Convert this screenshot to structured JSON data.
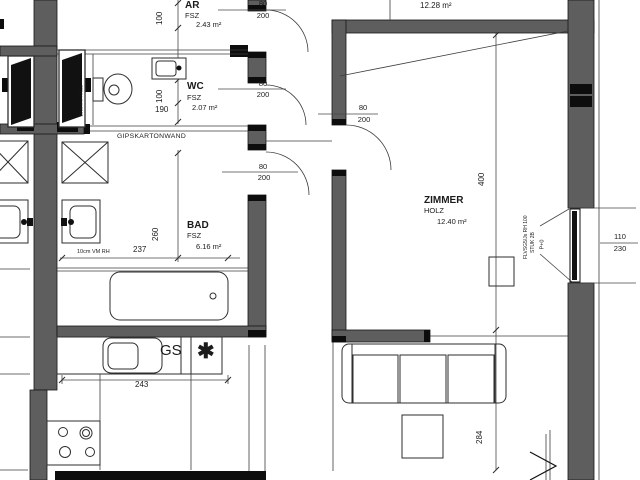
{
  "plan": {
    "rooms": [
      {
        "name": "AR",
        "floor": "FSZ",
        "area": "2.43 m²"
      },
      {
        "name": "WC",
        "floor": "FSZ",
        "area": "2.07 m²"
      },
      {
        "name": "BAD",
        "floor": "FSZ",
        "area": "6.16 m²"
      },
      {
        "name": "ZIMMER",
        "floor": "HOLZ",
        "area": "12.40 m²"
      },
      {
        "name": "HOLZ",
        "floor": "",
        "area": "12.28 m²"
      }
    ],
    "doors": {
      "ar": {
        "w": "80",
        "h": "200"
      },
      "wc": {
        "w": "80",
        "h": "200"
      },
      "bad": {
        "w": "80",
        "h": "200"
      },
      "zimmer": {
        "w": "80",
        "h": "200"
      }
    },
    "window": {
      "w": "110",
      "h": "230"
    },
    "dims": {
      "ar_height": "100",
      "wc_height": "100",
      "wc_width": "190",
      "bad_height": "260",
      "bad_width": "237",
      "kitchen_width": "243",
      "zimmer_height": "400",
      "living_height": "284"
    },
    "notes": {
      "gips": "GIPSKARTONWAND",
      "vm_rh": "10cm VM RH",
      "vm_wc": "10cmVM HR.2s",
      "gs": "GS",
      "star": "✱",
      "win1": "FLVSG5/Js RH 100",
      "win2": "STUK 2B",
      "win3": "P+0"
    },
    "colors": {
      "wall": "#5e5e5e",
      "line": "#3d3d3d",
      "black": "#0d0d0d",
      "bg": "#ffffff"
    }
  }
}
